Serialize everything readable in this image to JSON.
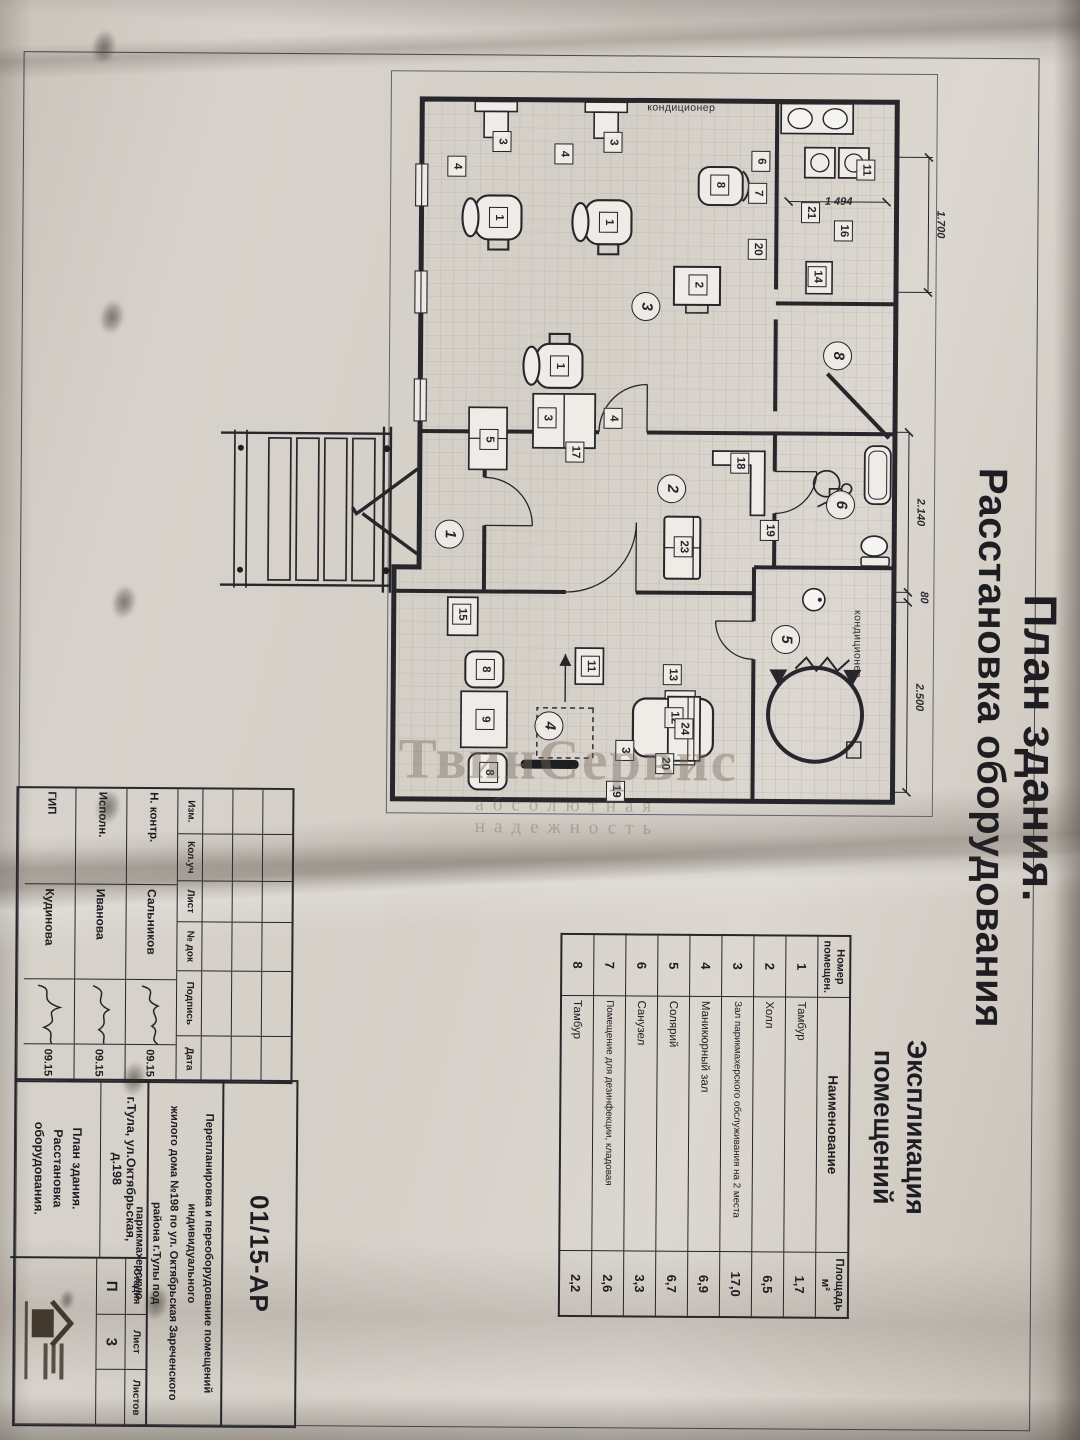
{
  "watermark": {
    "line1": "ТвинСервис",
    "line2": "абсолютная надежность"
  },
  "sheet": {
    "title_line1": "План здания.",
    "title_line2": "Расстановка оборудования"
  },
  "plan": {
    "room_numbers": [
      {
        "n": "1",
        "x": 485,
        "y": 497
      },
      {
        "n": "2",
        "x": 438,
        "y": 275
      },
      {
        "n": "3",
        "x": 256,
        "y": 302
      },
      {
        "n": "4",
        "x": 676,
        "y": 396
      },
      {
        "n": "5",
        "x": 588,
        "y": 160
      },
      {
        "n": "6",
        "x": 453,
        "y": 106
      },
      {
        "n": "8",
        "x": 304,
        "y": 110
      }
    ],
    "equipment_marks": [
      {
        "n": "3",
        "x": 92,
        "y": 447
      },
      {
        "n": "3",
        "x": 92,
        "y": 336
      },
      {
        "n": "4",
        "x": 117,
        "y": 492
      },
      {
        "n": "4",
        "x": 104,
        "y": 385
      },
      {
        "n": "1",
        "x": 168,
        "y": 450
      },
      {
        "n": "1",
        "x": 172,
        "y": 340
      },
      {
        "n": "1",
        "x": 316,
        "y": 388
      },
      {
        "n": "3",
        "x": 368,
        "y": 400
      },
      {
        "n": "17",
        "x": 402,
        "y": 372
      },
      {
        "n": "4",
        "x": 368,
        "y": 334
      },
      {
        "n": "5",
        "x": 390,
        "y": 458
      },
      {
        "n": "11",
        "x": 118,
        "y": 83
      },
      {
        "n": "16",
        "x": 179,
        "y": 105
      },
      {
        "n": "21",
        "x": 161,
        "y": 138
      },
      {
        "n": "14",
        "x": 225,
        "y": 131
      },
      {
        "n": "6",
        "x": 110,
        "y": 188
      },
      {
        "n": "7",
        "x": 142,
        "y": 191
      },
      {
        "n": "8",
        "x": 134,
        "y": 229
      },
      {
        "n": "20",
        "x": 198,
        "y": 191
      },
      {
        "n": "2",
        "x": 234,
        "y": 250
      },
      {
        "n": "18",
        "x": 412,
        "y": 207
      },
      {
        "n": "19",
        "x": 479,
        "y": 177
      },
      {
        "n": "23",
        "x": 496,
        "y": 263
      },
      {
        "n": "15",
        "x": 565,
        "y": 484
      },
      {
        "n": "8",
        "x": 620,
        "y": 460
      },
      {
        "n": "9",
        "x": 670,
        "y": 460
      },
      {
        "n": "8",
        "x": 723,
        "y": 456
      },
      {
        "n": "11",
        "x": 616,
        "y": 355
      },
      {
        "n": "13",
        "x": 624,
        "y": 273
      },
      {
        "n": "12",
        "x": 667,
        "y": 271
      },
      {
        "n": "20",
        "x": 713,
        "y": 280
      },
      {
        "n": "19",
        "x": 741,
        "y": 329
      },
      {
        "n": "3",
        "x": 700,
        "y": 320
      },
      {
        "n": "24",
        "x": 678,
        "y": 261
      }
    ],
    "dim_labels": [
      {
        "t": "1.700",
        "x": 172,
        "y": 14,
        "rot": 0
      },
      {
        "t": "1 494",
        "x": 150,
        "y": 110,
        "rot": -90
      },
      {
        "t": "2.140",
        "x": 460,
        "y": 32,
        "rot": 0
      },
      {
        "t": "80",
        "x": 545,
        "y": 28,
        "rot": 0
      },
      {
        "t": "2.500",
        "x": 645,
        "y": 32,
        "rot": 0
      }
    ],
    "ac_labels": [
      {
        "t": "кондиционер",
        "x": 57,
        "y": 268,
        "rot": -90
      },
      {
        "t": "кондиционер",
        "x": 592,
        "y": 88,
        "rot": 0
      }
    ]
  },
  "explication": {
    "title_line1": "Экспликация",
    "title_line2": "помещений",
    "headers": {
      "num": "Номер помещен.",
      "name": "Наименование",
      "area": "Площадь",
      "area_unit": "м²"
    },
    "rows": [
      {
        "num": "1",
        "name": "Тамбур",
        "area": "1,7"
      },
      {
        "num": "2",
        "name": "Холл",
        "area": "6,5"
      },
      {
        "num": "3",
        "name": "Зал парикмахерского обслуживания на 2 места",
        "area": "17,0"
      },
      {
        "num": "4",
        "name": "Маникюрный зал",
        "area": "6,9"
      },
      {
        "num": "5",
        "name": "Солярий",
        "area": "6,7"
      },
      {
        "num": "6",
        "name": "Санузел",
        "area": "3,3"
      },
      {
        "num": "7",
        "name": "Помещение  для дезинфекции, кладовая",
        "area": "2,6"
      },
      {
        "num": "8",
        "name": "Тамбур",
        "area": "2,2"
      }
    ]
  },
  "titleblock": {
    "rev_headers": [
      "Изм.",
      "Кол.уч",
      "Лист",
      "№ док",
      "Подпись",
      "Дата"
    ],
    "sign_rows": [
      {
        "role": "Н. контр.",
        "name": "Сальников",
        "date": "09.15"
      },
      {
        "role": "Исполн.",
        "name": "Иванова",
        "date": "09.15"
      },
      {
        "role": "ГИП",
        "name": "Кудинова",
        "date": "09.15"
      }
    ],
    "doc_code": "01/15-АР",
    "project_l1": "Перепланировка и переоборудование помещений индивидуального",
    "project_l2": "жилого дома №198 по ул. Октябрьская Зареченского района г.Тулы под",
    "project_l3": "парикмахерскую",
    "address": "г.Тула, ул.Октябрьская, д.198",
    "sheet_name": "План здания. Расстановка оборудования.",
    "stage_label": "Стадия",
    "list_label": "Лист",
    "lists_label": "Листов",
    "stage": "П",
    "list_no": "3",
    "lists_no": ""
  }
}
